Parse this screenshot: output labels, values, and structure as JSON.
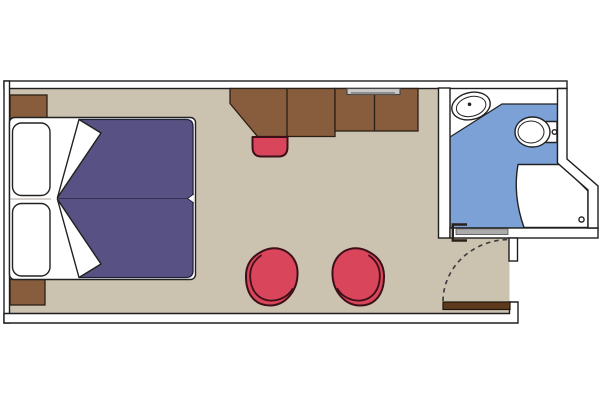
{
  "title": "cabin-floor-plan",
  "colors": {
    "background": "#ffffff",
    "wall_fill": "#ffffff",
    "wall_stroke": "#1f1f1f",
    "floor": "#cbc2b0",
    "bathroom_floor": "#7ba1d6",
    "bathroom_tile": "#ffffff",
    "furniture_brown": "#875d3d",
    "furniture_outline": "#2b2015",
    "door_brown": "#5e3a1d",
    "door_outline": "#20150b",
    "duvet_purple": "#585284",
    "duvet_outline": "#21203a",
    "linen_white": "#ffffff",
    "chair_red": "#d9455a",
    "chair_outline": "#3d1019",
    "fixture_outline": "#222222",
    "tv_gray": "#c9c9c9",
    "tv_dark": "#8f8f8f",
    "threshold_gray": "#ababab",
    "arc_dash": "#3a3a3a"
  },
  "items": [
    "double-bed",
    "pillow",
    "pillow",
    "nightstand",
    "nightstand",
    "desk-wardrobe-unit",
    "tv",
    "stool",
    "tub-chair",
    "tub-chair",
    "entry-door",
    "door-swing",
    "bathroom",
    "sink",
    "toilet",
    "shower"
  ]
}
